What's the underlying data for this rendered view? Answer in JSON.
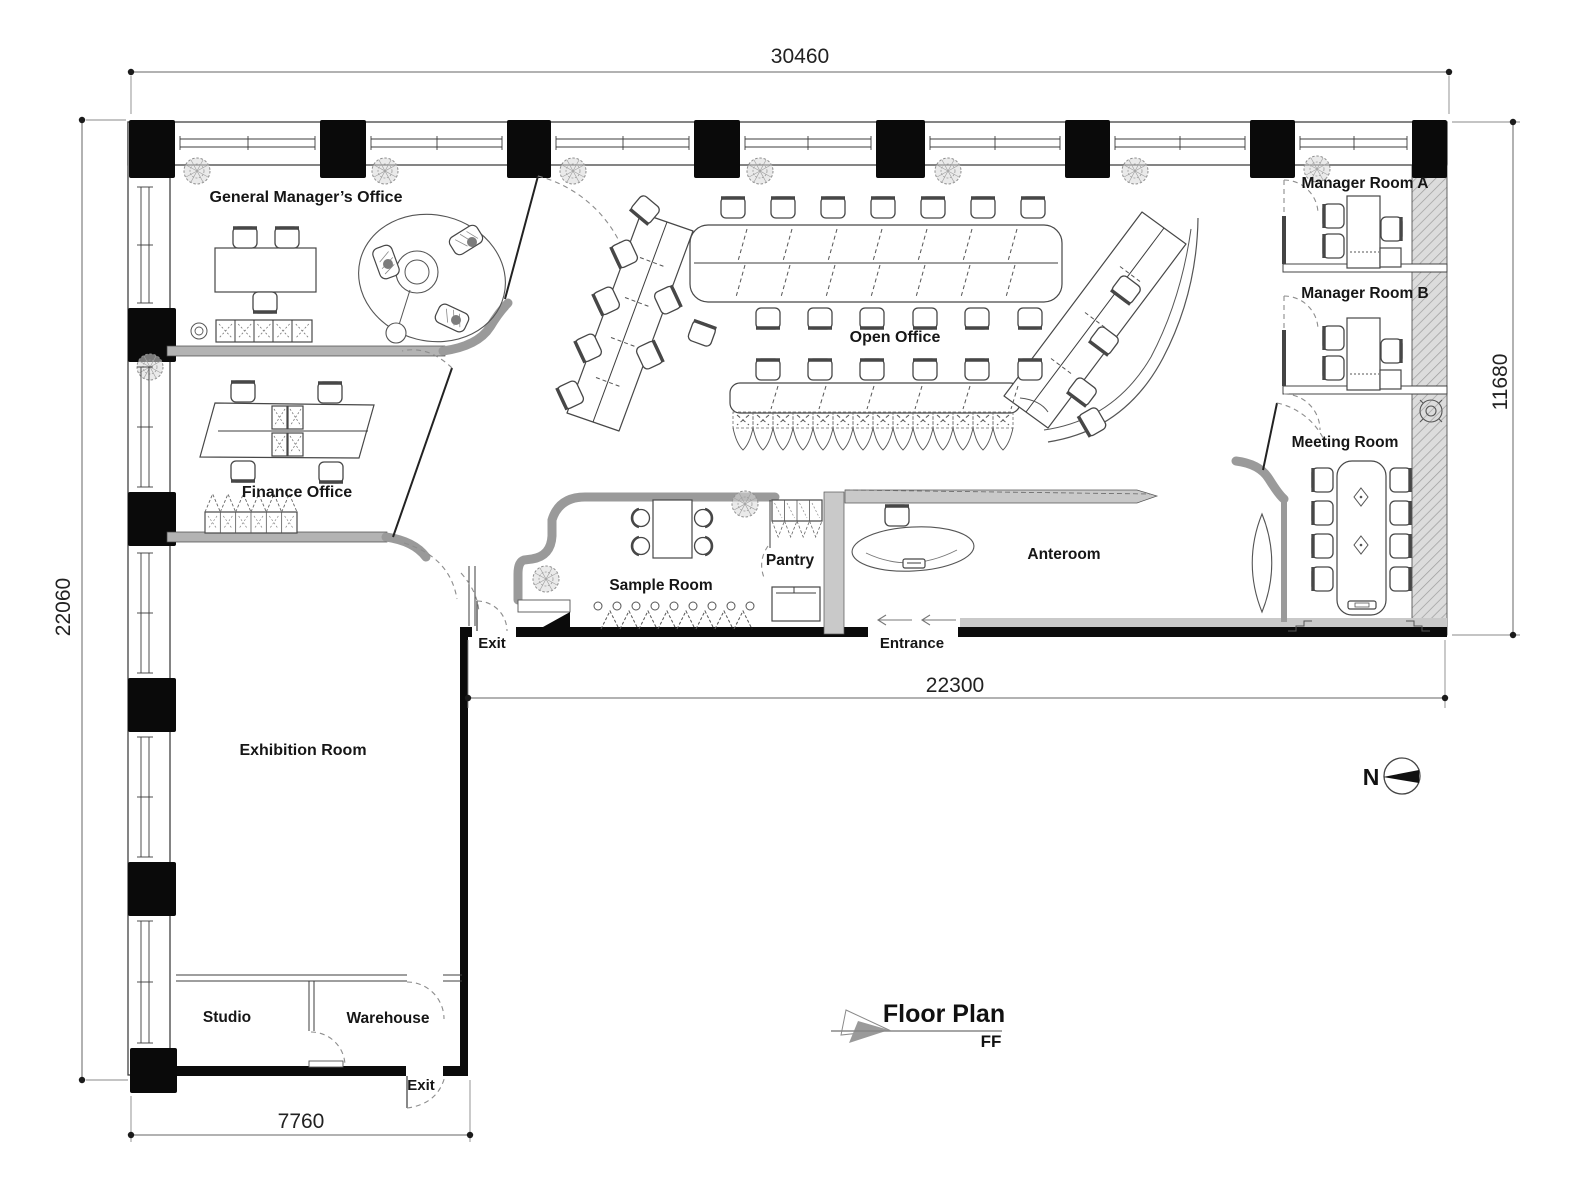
{
  "dimensions": {
    "overall_width": "30460",
    "overall_height": "22060",
    "right_height": "11680",
    "inner_width": "22300",
    "bottom_width": "7760"
  },
  "rooms": {
    "gm_office": "General Manager’s Office",
    "manager_a": "Manager Room A",
    "manager_b": "Manager Room B",
    "open_office": "Open Office",
    "finance": "Finance Office",
    "meeting": "Meeting Room",
    "sample": "Sample Room",
    "pantry": "Pantry",
    "anteroom": "Anteroom",
    "exhibition": "Exhibition Room",
    "studio": "Studio",
    "warehouse": "Warehouse"
  },
  "doors": {
    "exit_upper": "Exit",
    "entrance": "Entrance",
    "exit_lower": "Exit"
  },
  "compass": {
    "north": "N"
  },
  "title": {
    "name": "Floor Plan",
    "level": "FF"
  }
}
